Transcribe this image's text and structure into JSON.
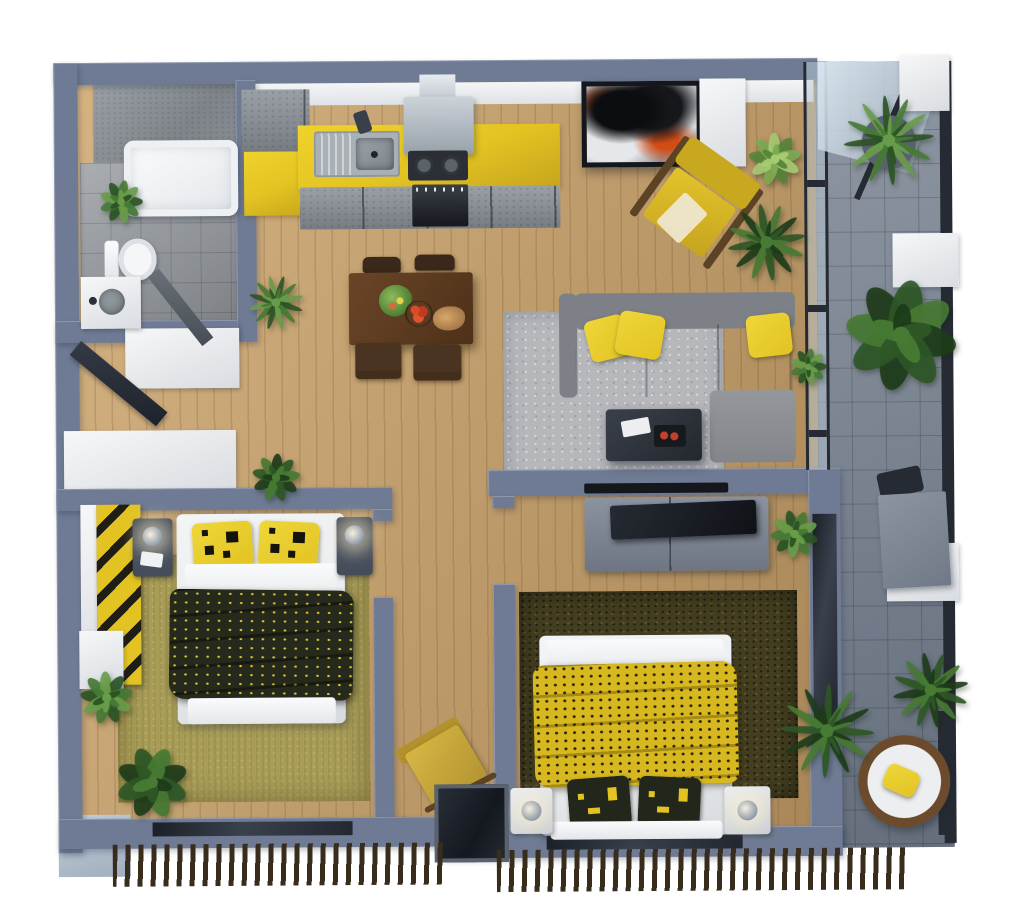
{
  "meta": {
    "kind": "3d-floor-plan-render",
    "text_visible": false
  },
  "colors": {
    "wall": "#6f7b94",
    "wallDeep": "#515b70",
    "wood": "#c59d66",
    "bathTile": "#979ca1",
    "balconyTile": "#7d8795",
    "rugLiving": "#b5b7bb",
    "rugOlive": "#a89c57",
    "rugDark": "#433e20",
    "yellow": "#e2c322",
    "sofa": "#8d9095",
    "linen": "#e9ebee",
    "frame": "#262b33",
    "louver": "#382d1c",
    "tableWood": "#4e3118",
    "chairWood": "#3a281a",
    "steel": "#a9b1b7",
    "nightstand": "#454d5b",
    "blanketDark": "#262a1c",
    "orange": "#d14d15"
  },
  "objects": [
    "bathtub",
    "toilet",
    "bathroom-sink",
    "shower-area",
    "kitchen-counter",
    "kitchen-sink",
    "gas-stove",
    "range-hood",
    "oven",
    "tall-cabinet",
    "dining-table",
    "dining-chairs",
    "fruit-bowl",
    "flower-centerpiece",
    "sectional-sofa",
    "yellow-throw-pillows",
    "coffee-table",
    "wall-art",
    "accent-armchair",
    "living-rug",
    "tv-wall-strip",
    "tv-console",
    "television",
    "bedroom1-double-bed",
    "striped-wardrobe",
    "nightstands",
    "olive-rug",
    "bedroom2-double-bed",
    "dark-shag-rug",
    "lounge-chair",
    "balcony-glass-wall",
    "balcony-table",
    "papasan-chair",
    "louvered-railing",
    "entrance-door"
  ],
  "plants": [
    {
      "name": "bathroom-plant",
      "x": 96,
      "y": 172,
      "s": 54,
      "type": "leafy",
      "tone": "mid"
    },
    {
      "name": "dining-plant",
      "x": 246,
      "y": 270,
      "s": 62,
      "type": "fern",
      "tone": "mid"
    },
    {
      "name": "hallway-plant",
      "x": 246,
      "y": 446,
      "s": 60,
      "type": "leafy",
      "tone": "dark"
    },
    {
      "name": "living-fern",
      "x": 724,
      "y": 200,
      "s": 88,
      "type": "fern",
      "tone": "dark"
    },
    {
      "name": "living-light-plant",
      "x": 744,
      "y": 128,
      "s": 66,
      "type": "leafy",
      "tone": "light"
    },
    {
      "name": "balcony-palm",
      "x": 846,
      "y": 98,
      "s": 90,
      "type": "palm",
      "tone": "mid",
      "pot": true
    },
    {
      "name": "balcony-large-plant",
      "x": 840,
      "y": 276,
      "s": 124,
      "type": "broad",
      "tone": "dark"
    },
    {
      "name": "balcony-small-plant",
      "x": 786,
      "y": 346,
      "s": 46,
      "type": "leafy",
      "tone": "mid"
    },
    {
      "name": "bedroom2-plant",
      "x": 764,
      "y": 506,
      "s": 60,
      "type": "leafy",
      "tone": "mid"
    },
    {
      "name": "bedroom2-palm",
      "x": 778,
      "y": 686,
      "s": 94,
      "type": "palm",
      "tone": "dark"
    },
    {
      "name": "balcony-fern",
      "x": 886,
      "y": 650,
      "s": 86,
      "type": "fern",
      "tone": "dark"
    },
    {
      "name": "bedroom1-plant-left",
      "x": 72,
      "y": 662,
      "s": 66,
      "type": "leafy",
      "tone": "mid"
    },
    {
      "name": "bedroom1-plant-bottom",
      "x": 110,
      "y": 740,
      "s": 80,
      "type": "broad",
      "tone": "dark"
    }
  ]
}
